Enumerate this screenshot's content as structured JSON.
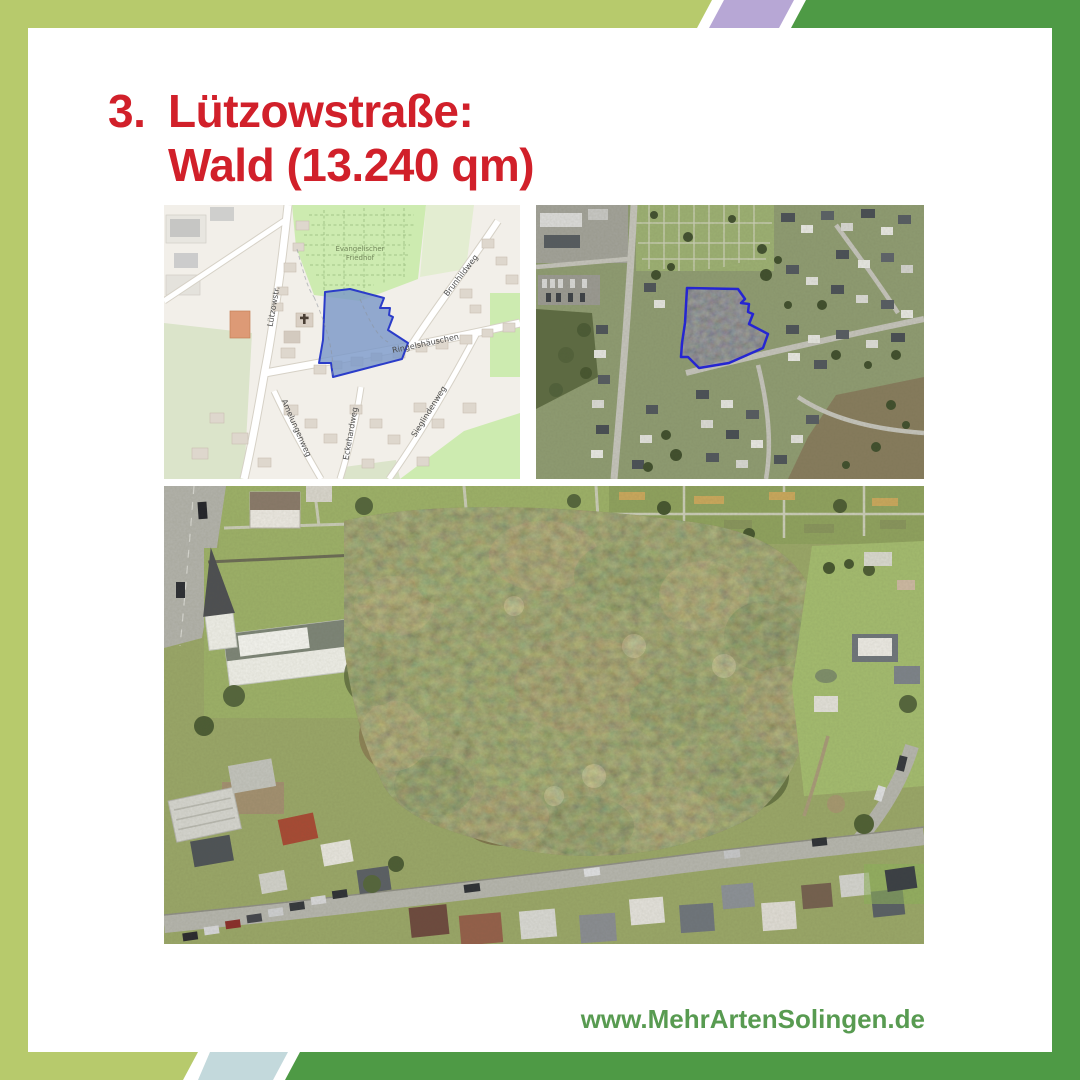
{
  "heading": {
    "number": "3.",
    "line1": "Lützowstraße:",
    "line2": "Wald (13.240 qm)",
    "color": "#d1202a"
  },
  "footer": {
    "website": "www.MehrArtenSolingen.de",
    "color": "#589b51"
  },
  "frame": {
    "light_green": "#b7ca6c",
    "dark_green": "#4e9a45",
    "lavender": "#b7a7d5",
    "pale_blue": "#c3d9dc"
  },
  "street_map": {
    "cemetery_line1": "Evangelischer",
    "cemetery_line2": "Friedhof",
    "streets": {
      "luetzowstr": "Lützowstr.",
      "brunhildweg": "Brunhildweg",
      "ringelshaeuschen": "Ringelshäuschen",
      "eckehardweg": "Eckehardweg",
      "amelungenweg": "Amelungenweg",
      "sieglindenweg": "Sieglindenweg"
    },
    "highlight_fill": "#7b99c8",
    "highlight_stroke": "#2b3cc9"
  },
  "satellite": {
    "highlight_fill": "#3a2e99",
    "highlight_stroke": "#2121dd"
  }
}
